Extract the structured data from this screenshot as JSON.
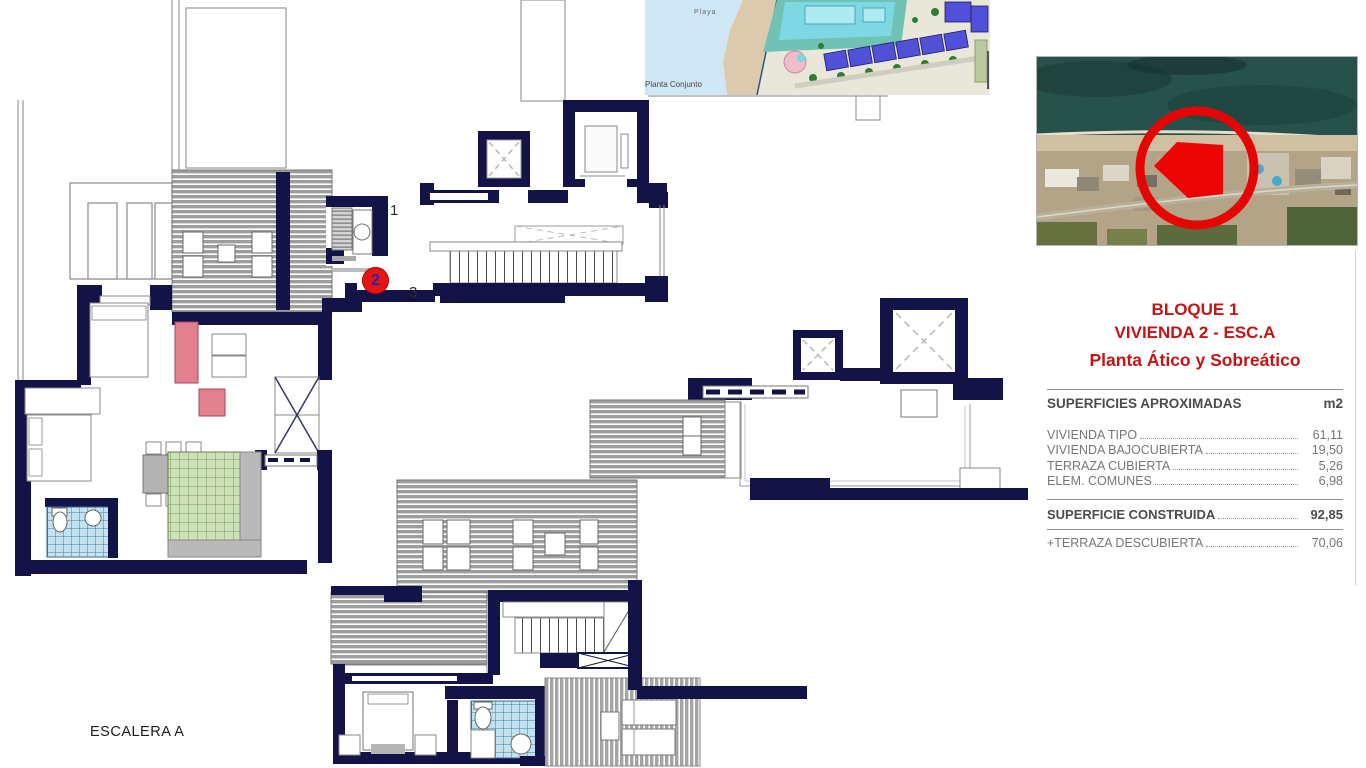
{
  "document": {
    "escalera_label": "ESCALERA A"
  },
  "site_plan": {
    "caption": "Planta Conjunto",
    "beach_label": "Playa"
  },
  "aerial_photo": {
    "highlight_color": "#e60505"
  },
  "floor_plan": {
    "markers": {
      "landing_label_1": "1",
      "unit_number": "2",
      "landing_label_3": "3"
    },
    "colors": {
      "wall": "#131347",
      "roof_hatch": "#9d9d9d",
      "kitchen_tile": "#cde0b8",
      "bath_tile": "#c2e2ef",
      "sofa": "#e2808e",
      "unit_marker": "#e81414"
    }
  },
  "info_panel": {
    "accent_color": "#c41414",
    "title_line1": "BLOQUE 1",
    "title_line2": "VIVIENDA 2 - ESC.A",
    "title_line3": "Planta Ático y Sobreático",
    "surface_table": {
      "header_label": "SUPERFICIES APROXIMADAS",
      "header_unit": "m2",
      "rows": [
        {
          "label": "VIVIENDA TIPO",
          "value": "61,11"
        },
        {
          "label": "VIVIENDA BAJOCUBIERTA",
          "value": "19,50"
        },
        {
          "label": "TERRAZA CUBIERTA",
          "value": "5,26"
        },
        {
          "label": "ELEM. COMUNES",
          "value": "6,98"
        }
      ],
      "total_row": {
        "label": "SUPERFICIE CONSTRUIDA",
        "value": "92,85"
      },
      "extra_row": {
        "label": "+TERRAZA DESCUBIERTA",
        "value": "70,06"
      }
    }
  }
}
